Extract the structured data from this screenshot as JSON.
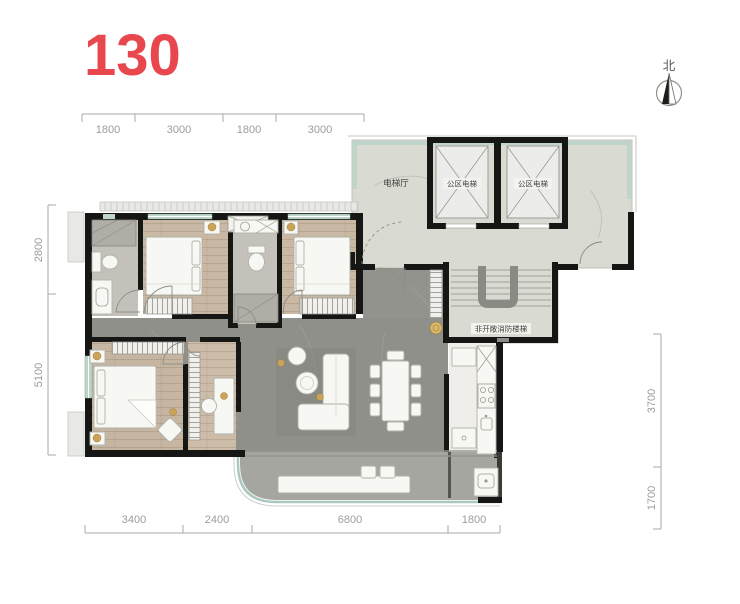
{
  "title": "130",
  "north_label": "北",
  "labels": {
    "elevator_hall": "电梯厅",
    "elevator_left": "公区电梯",
    "elevator_right": "公区电梯",
    "fire_stairs": "非开敞消防楼梯"
  },
  "dimensions": {
    "top": [
      "1800",
      "3000",
      "1800",
      "3000"
    ],
    "left": [
      "2800",
      "5100"
    ],
    "right": [
      "3700",
      "1700"
    ],
    "bottom": [
      "3400",
      "2400",
      "6800",
      "1800"
    ]
  },
  "colors": {
    "accent": "#e8484d",
    "wall": "#161614",
    "wood_floor": "#c8b8a4",
    "marble_floor": "#90908a",
    "core_floor": "#d9dbd3",
    "glass_railing": "#a9c8c0",
    "gold_accent": "#c9a357"
  }
}
